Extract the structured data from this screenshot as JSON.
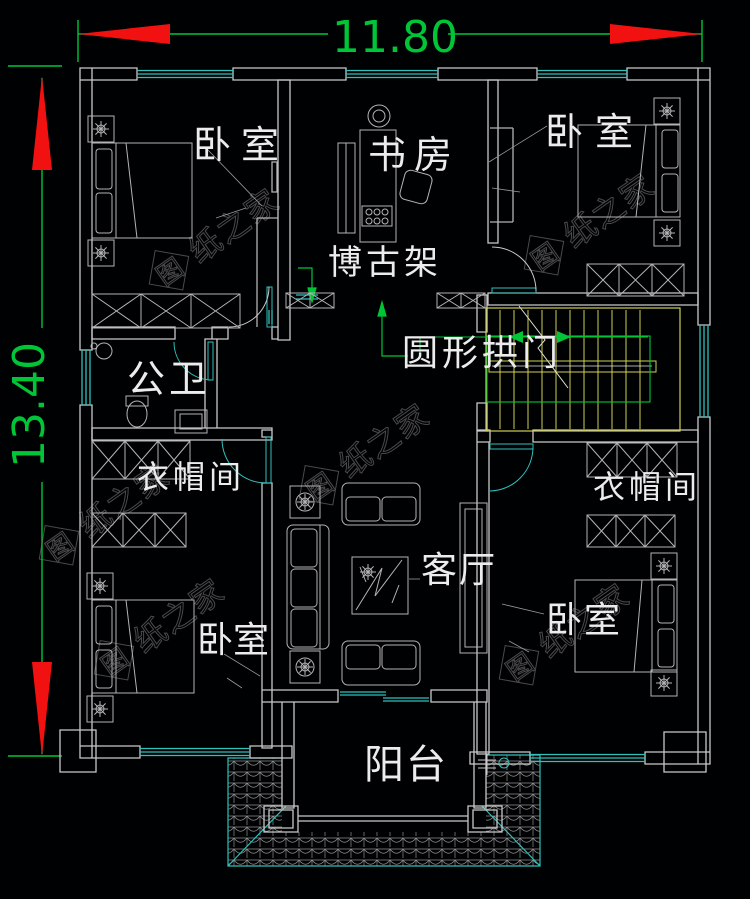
{
  "drawing": {
    "kind": "cad-floor-plan",
    "background": "#000103"
  },
  "dimensions": {
    "width": "11.80",
    "height": "13.40"
  },
  "labels": {
    "bedroom_top_left": "卧室",
    "study": "书房",
    "antique_shelf": "博古架",
    "bedroom_top_right": "卧室",
    "bathroom": "公卫",
    "cloakroom_left": "衣帽间",
    "round_arch": "圆形拱门",
    "cloakroom_right": "衣帽间",
    "living_room": "客厅",
    "bedroom_bottom_left": "卧室",
    "bedroom_bottom_right": "卧室",
    "balcony": "阳台"
  },
  "watermark": {
    "logo": "图",
    "name": "纸之家"
  },
  "colors": {
    "wall": "#c9c9c9",
    "furniture": "#b4b4b4",
    "window_door": "#2fc1bc",
    "dimension_green": "#00c637",
    "arrow_red": "#f21111",
    "stairs_yellow": "#cfcf52",
    "label_text": "#ececec",
    "watermark": "#787878"
  }
}
